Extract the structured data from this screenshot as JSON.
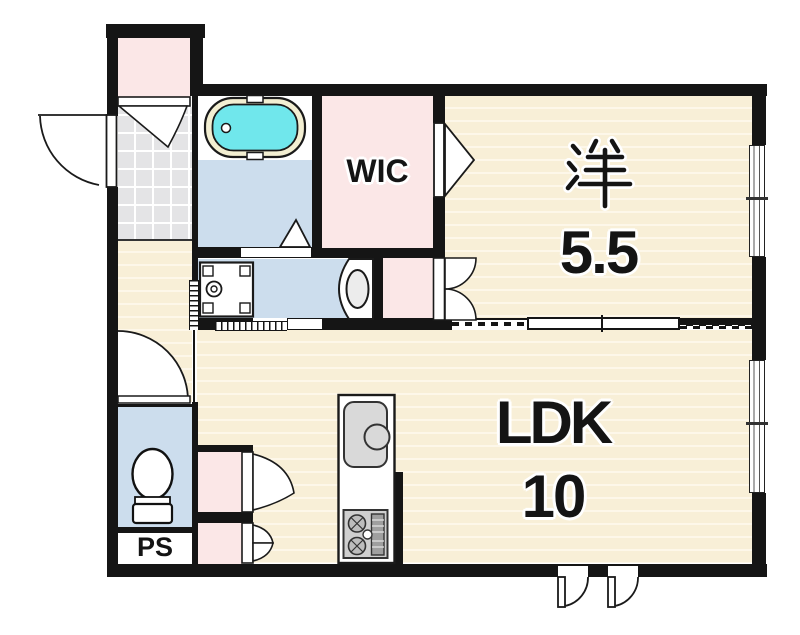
{
  "labels": {
    "western_room_kanji": "洋",
    "western_room_size": "5.5",
    "ldk_name": "LDK",
    "ldk_size": "10",
    "wic": "WIC",
    "pipe_space": "PS"
  },
  "colors": {
    "wall": "#151515",
    "wood_floor": "#f8efd7",
    "wood_floor_stripe": "#fdf7e9",
    "pink_room": "#fbe7e7",
    "wet_area_blue": "#ccdded",
    "entrance_tile_gray": "#e4e4e6",
    "bathtub_cyan": "#70e7ec",
    "bathtub_rim_cream": "#f3efd2",
    "fixture_gray": "#d9d9d9",
    "background": "#ffffff"
  },
  "fixtures": [
    "bathtub",
    "washing-machine-pan",
    "washbasin",
    "toilet",
    "kitchen-sink",
    "gas-stove"
  ]
}
